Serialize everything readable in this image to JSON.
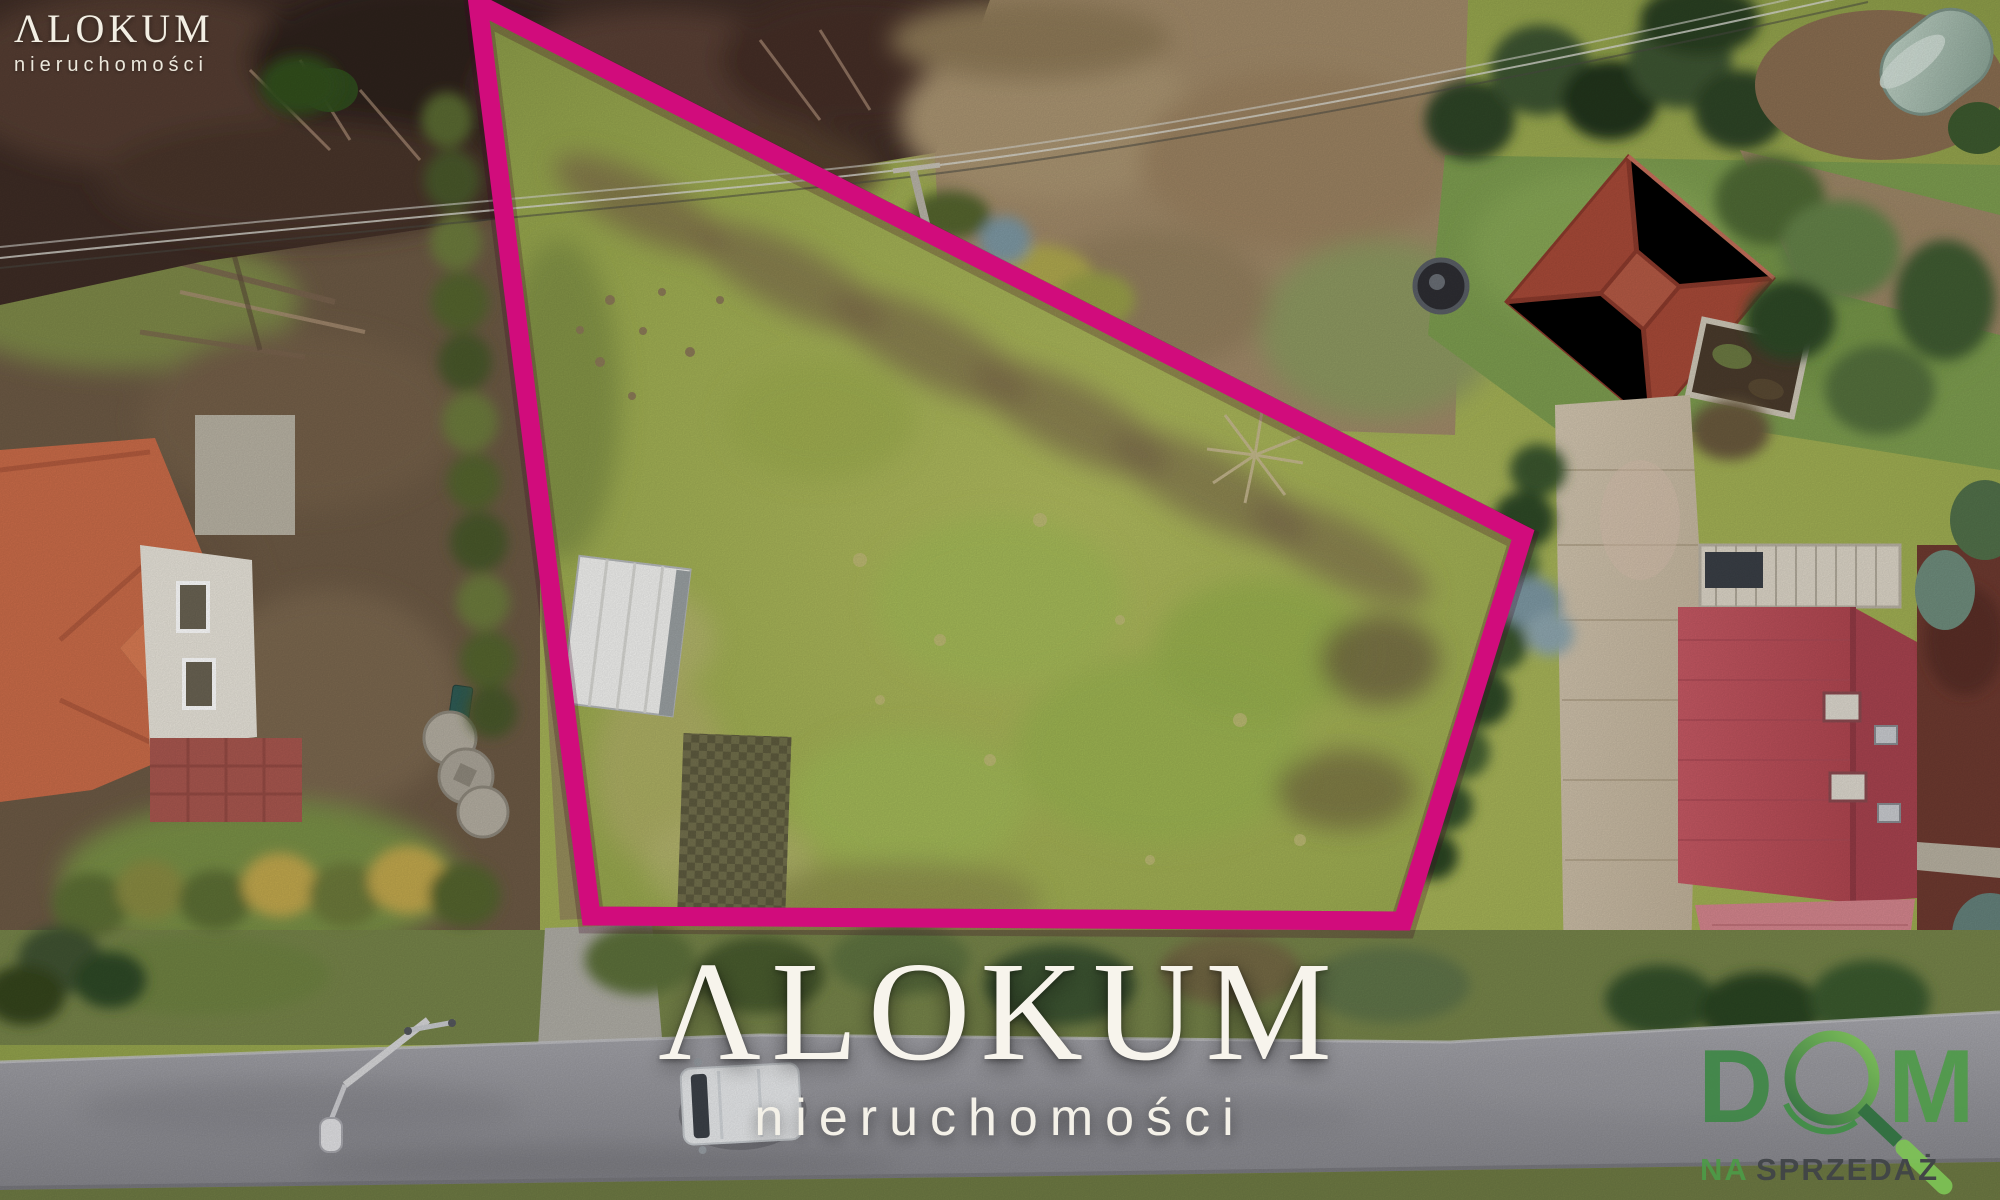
{
  "branding": {
    "corner_logo": {
      "name": "ΛLOKUM",
      "subtitle": "nieruchomości"
    },
    "center_watermark": {
      "name": "ΛLOKUM",
      "subtitle": "nieruchomości"
    },
    "agency_logo": {
      "letter_d": "D",
      "letter_m": "M",
      "caption_prefix": "NA",
      "caption_word": "SPRZEDAŻ"
    }
  },
  "plot_outline": {
    "color": "#d10c7c",
    "points_str": "478,4 1523,535 1403,921 591,916"
  },
  "colors": {
    "boundary_magenta": "#d10c7c",
    "watermark_white": "#f7f4ec",
    "logo_green_dark": "#2d6f3c",
    "logo_green_mid": "#3f8f45",
    "logo_green_light": "#7dc455",
    "caption_gray": "#3f4347"
  }
}
